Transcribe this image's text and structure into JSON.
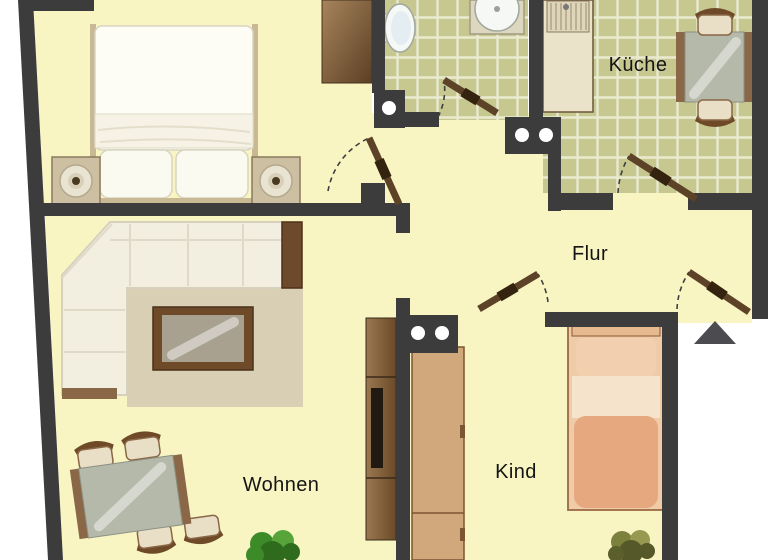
{
  "colors": {
    "wall": "#3c3c3c",
    "floor": "#f8f5c3",
    "tile": "#c6c890",
    "tileGrid": "#e9ead0",
    "doorLeaf": "#5c4226",
    "doorLeafDark": "#33230f",
    "woodDark": "#6e4a28",
    "woodMid": "#8a6747",
    "glass": "#b4b9aa",
    "sofa": "#f2eee0",
    "rug": "#d8cfb4",
    "tan": "#d0a87c",
    "bedSalmon": "#e5a87f",
    "bedBand": "#f6e3cb",
    "bedPillow": "#f2cfae",
    "plantGreen": "#3c8a28",
    "plantOlive": "#7b803d",
    "arrow": "#4c4c50"
  },
  "rooms": {
    "kueche": {
      "label": "Küche"
    },
    "flur": {
      "label": "Flur"
    },
    "wohnen": {
      "label": "Wohnen"
    },
    "kind": {
      "label": "Kind"
    }
  },
  "furniture_inventory": {
    "bedroom_unlabeled": [
      "double-bed",
      "nightstand-with-lamp-left",
      "nightstand-with-lamp-right",
      "wardrobe"
    ],
    "bathroom_unlabeled": [
      "toilet",
      "round-washbasin"
    ],
    "kueche": [
      "counter-with-sink",
      "glass-dining-table",
      "chair-top",
      "chair-bottom"
    ],
    "wohnen": [
      "corner-sofa",
      "rug",
      "coffee-table",
      "side-cabinet",
      "tv-cabinet",
      "glass-dining-table",
      "chairs-x4",
      "plant"
    ],
    "kind": [
      "wardrobe",
      "single-bed",
      "plant"
    ]
  },
  "markers": {
    "entrance_arrow": "triangle-pointing-into-apartment",
    "wall_hinge_dots": [
      "single-dot-bath-wall",
      "double-dot-hall-wall",
      "double-dot-child-wall"
    ]
  }
}
